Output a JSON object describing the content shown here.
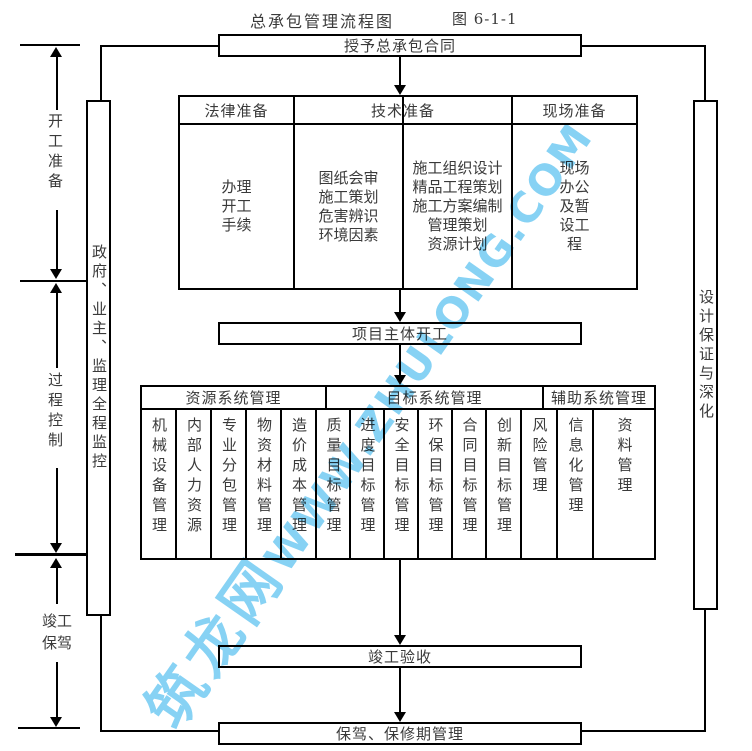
{
  "title": {
    "main": "总承包管理流程图",
    "figure": "图 6-1-1"
  },
  "watermark": {
    "cn": "筑龙网",
    "en": "WWW.ZHULONG.COM",
    "color": "#54BFEF"
  },
  "boxes": {
    "award": "授予总承包合同",
    "start": "项目主体开工",
    "acceptance": "竣工验收",
    "warranty": "保驾、保修期管理"
  },
  "prep": {
    "headers": [
      "法律准备",
      "技术准备",
      "现场准备"
    ],
    "legal": "办理\n开工\n手续",
    "tech_left": "图纸会审\n施工策划\n危害辨识\n环境因素",
    "tech_right": "施工组织设计\n精品工程策划\n施工方案编制\n管理策划\n资源计划",
    "site": "现场\n办公\n及暂\n设工\n程"
  },
  "mgmt": {
    "headers": [
      "资源系统管理",
      "目标系统管理",
      "辅助系统管理"
    ],
    "resource": [
      "机械设备管理",
      "内部人力资源",
      "专业分包管理",
      "物资材料管理",
      "造价成本管理"
    ],
    "target": [
      "质量目标管理",
      "进度目标管理",
      "安全目标管理",
      "环保目标管理",
      "合同目标管理",
      "创新目标管理"
    ],
    "aux": [
      "风险管理",
      "信息化管理",
      "资料管理"
    ]
  },
  "sidebars": {
    "left": "政府、业主、监理全程监控",
    "right": "设计保证与深化"
  },
  "phases": {
    "p1": "开工准备",
    "p2": "过程控制",
    "p3": "竣工保驾"
  }
}
